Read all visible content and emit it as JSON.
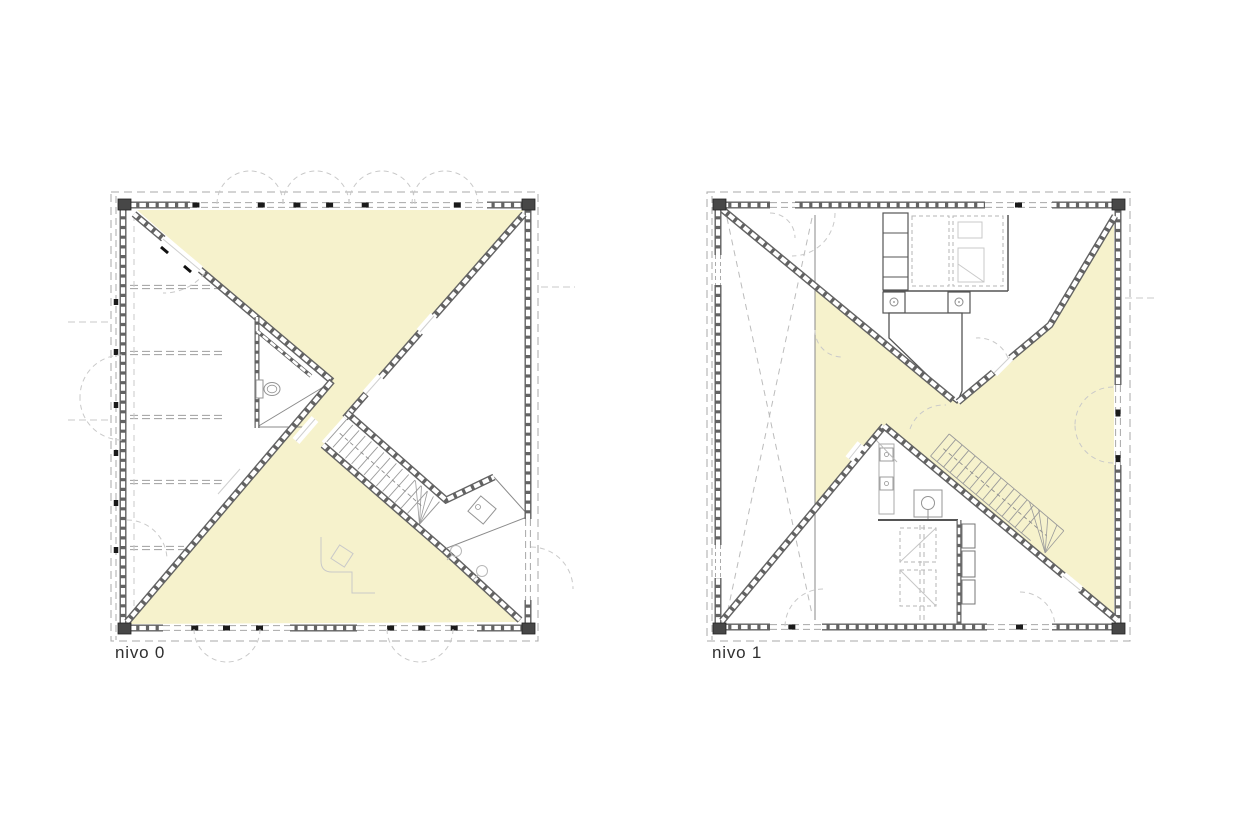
{
  "page": {
    "background": "#ffffff"
  },
  "plans": [
    {
      "id": "nivo-0",
      "label": "nivo 0"
    },
    {
      "id": "nivo-1",
      "label": "nivo 1"
    }
  ],
  "colors": {
    "background": "#ffffff",
    "highlight_fill": "#f6f2cc",
    "wall_dark": "#636363",
    "wall_block": "#ffffff",
    "corner_block": "#474747",
    "thin_wall": "#555555",
    "dashed_line": "#a8a8a8",
    "light_line": "#c9c9c9",
    "tread_line": "#9a9a9a",
    "fixture_line": "#949494",
    "post": "#1a1a1a",
    "label_text": "#2f2f2f"
  }
}
